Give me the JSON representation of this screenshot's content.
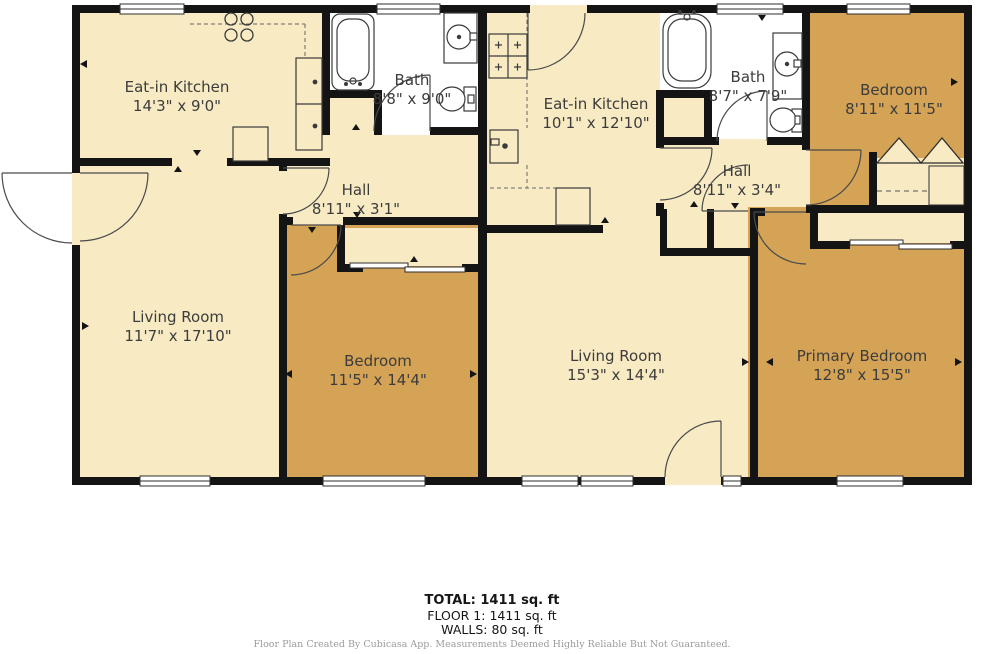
{
  "floorplan": {
    "rooms": {
      "kitchen_left": {
        "name": "Eat-in Kitchen",
        "dims": "14'3\" x 9'0\""
      },
      "bath_left": {
        "name": "Bath",
        "dims": "8'8\" x 9'0\""
      },
      "hall_left": {
        "name": "Hall",
        "dims": "8'11\" x 3'1\""
      },
      "kitchen_right": {
        "name": "Eat-in Kitchen",
        "dims": "10'1\" x 12'10\""
      },
      "bath_right": {
        "name": "Bath",
        "dims": "8'7\" x 7'9\""
      },
      "bedroom_right": {
        "name": "Bedroom",
        "dims": "8'11\" x 11'5\""
      },
      "hall_right": {
        "name": "Hall",
        "dims": "8'11\" x 3'4\""
      },
      "living_left": {
        "name": "Living Room",
        "dims": "11'7\" x 17'10\""
      },
      "bedroom_left": {
        "name": "Bedroom",
        "dims": "11'5\" x 14'4\""
      },
      "living_right": {
        "name": "Living Room",
        "dims": "15'3\" x 14'4\""
      },
      "primary_bedroom": {
        "name": "Primary Bedroom",
        "dims": "12'8\" x 15'5\""
      }
    },
    "summary": {
      "total": "TOTAL: 1411 sq. ft",
      "floor1": "FLOOR 1: 1411 sq. ft",
      "walls": "WALLS: 80 sq. ft"
    },
    "disclaimer": "Floor Plan Created By Cubicasa App. Measurements Deemed Highly Reliable But Not Guaranteed.",
    "colors": {
      "floor_cream": "#f8ebc4",
      "floor_tan": "#d5a356",
      "bath_white": "#ffffff",
      "wall_black": "#141414"
    }
  }
}
